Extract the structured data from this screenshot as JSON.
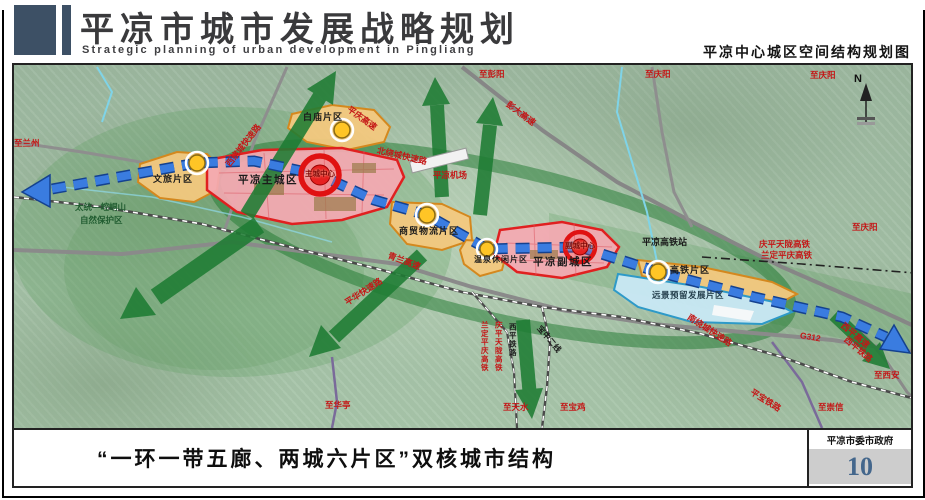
{
  "header": {
    "title": "平凉市城市发展战略规划",
    "subtitle_en": "Strategic planning of urban development in Pingliang",
    "map_title": "平凉中心城区空间结构规划图"
  },
  "footer": {
    "caption": "“一环一带五廊、两城六片区”双核城市结构",
    "agency": "平凉市委市政府",
    "page_number": "10"
  },
  "map": {
    "compass": "N",
    "labels": [
      {
        "text": "至兰州"
      },
      {
        "text": "太统—崆峒山"
      },
      {
        "text": "自然保护区"
      },
      {
        "text": "文旅片区"
      },
      {
        "text": "平凉主城区"
      },
      {
        "text": "主城中心"
      },
      {
        "text": "白庙片区"
      },
      {
        "text": "西绕城快速路"
      },
      {
        "text": "北绕城快速路"
      },
      {
        "text": "平庆高速"
      },
      {
        "text": "至彭阳"
      },
      {
        "text": "彭大高速"
      },
      {
        "text": "至庆阳"
      },
      {
        "text": "平凉机场"
      },
      {
        "text": "商贸物流片区"
      },
      {
        "text": "温泉休闲片区"
      },
      {
        "text": "平凉副城区"
      },
      {
        "text": "副城中心"
      },
      {
        "text": "平凉高铁站"
      },
      {
        "text": "庆平天陇高铁"
      },
      {
        "text": "兰定平庆高铁"
      },
      {
        "text": "高铁片区"
      },
      {
        "text": "远景预留发展片区"
      },
      {
        "text": "南绕城快速路"
      },
      {
        "text": "青兰高速"
      },
      {
        "text": "平华快速路"
      },
      {
        "text": "至华亭"
      },
      {
        "text": "西平铁路"
      },
      {
        "text": "庆平天陇高铁"
      },
      {
        "text": "兰定平庆高铁"
      },
      {
        "text": "宝中二线"
      },
      {
        "text": "至天水"
      },
      {
        "text": "至宝鸡"
      },
      {
        "text": "G312"
      },
      {
        "text": "西平高速"
      },
      {
        "text": "西平铁路"
      },
      {
        "text": "至西安"
      },
      {
        "text": "至崇信"
      },
      {
        "text": "平宝铁路"
      },
      {
        "text": "至庆阳"
      },
      {
        "text": "至庆阳"
      }
    ]
  },
  "colors": {
    "header_accent": "#3d5065",
    "map_background": "#a7c3a9",
    "corridor_green": "#1e7c33",
    "axis_blue": "#3a7ce0",
    "city_zone_fill": "#f4a9b2",
    "city_zone_border": "#e02020",
    "district_zone_fill": "#f3c87e",
    "district_zone_border": "#d4881e",
    "reserve_zone_fill": "#c8e8f4",
    "reserve_zone_border": "#2e9ac8",
    "node_yellow": "#ffc526",
    "label_red": "#c41616",
    "page_number_blue": "#44678c"
  }
}
